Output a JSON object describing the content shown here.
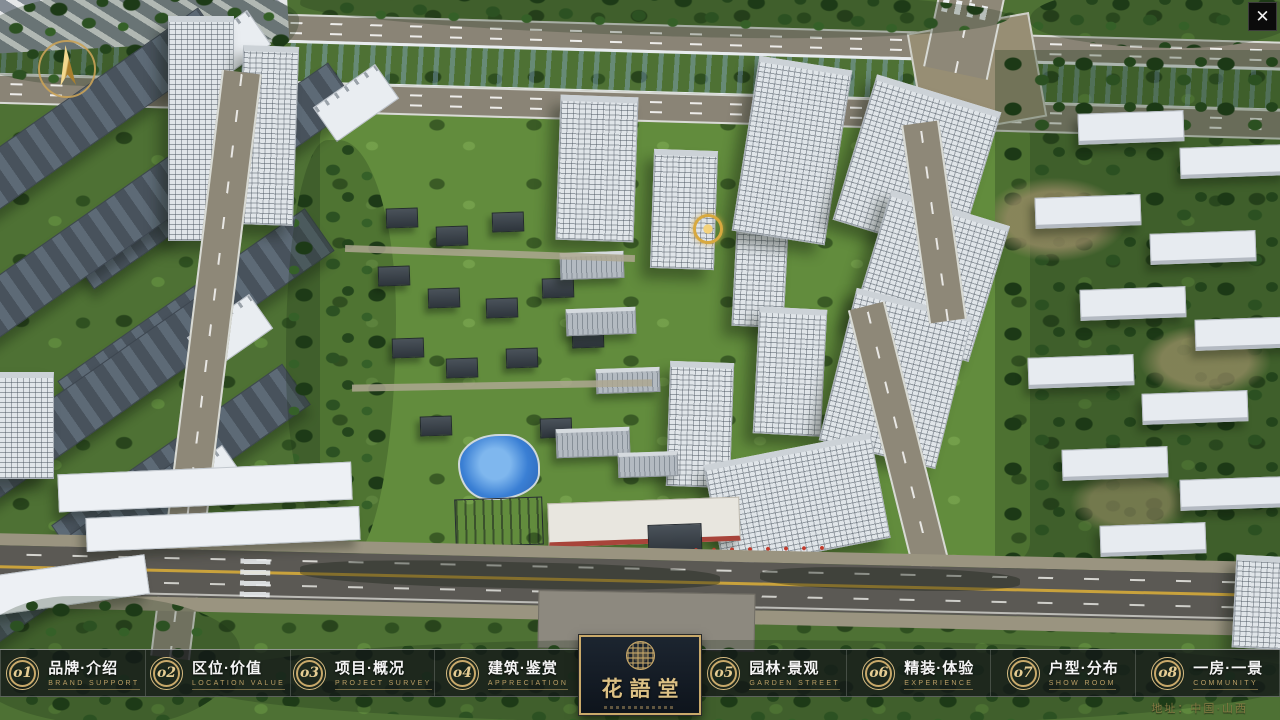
{
  "window": {
    "close_glyph": "✕"
  },
  "nav": {
    "items": [
      {
        "num": "o1",
        "label": "品牌·介绍",
        "sublabel": "BRAND SUPPORT"
      },
      {
        "num": "o2",
        "label": "区位·价值",
        "sublabel": "LOCATION VALUE"
      },
      {
        "num": "o3",
        "label": "项目·概况",
        "sublabel": "PROJECT SURVEY"
      },
      {
        "num": "o4",
        "label": "建筑·鉴赏",
        "sublabel": "APPRECIATION"
      },
      {
        "num": "o5",
        "label": "园林·景观",
        "sublabel": "GARDEN STREET"
      },
      {
        "num": "o6",
        "label": "精装·体验",
        "sublabel": "EXPERIENCE"
      },
      {
        "num": "o7",
        "label": "户型·分布",
        "sublabel": "SHOW ROOM"
      },
      {
        "num": "o8",
        "label": "一房·一景",
        "sublabel": "COMMUNITY"
      }
    ]
  },
  "logo": {
    "title": "花語堂"
  },
  "footer": {
    "address": "地址：中国·山西"
  },
  "colors": {
    "gold": "#c9a96a",
    "bar_background": "rgba(17,19,23,0.72)",
    "river_blue": "#2f55c0",
    "label_white": "#f5f5f5",
    "sublabel_gold": "#bb9f66"
  }
}
